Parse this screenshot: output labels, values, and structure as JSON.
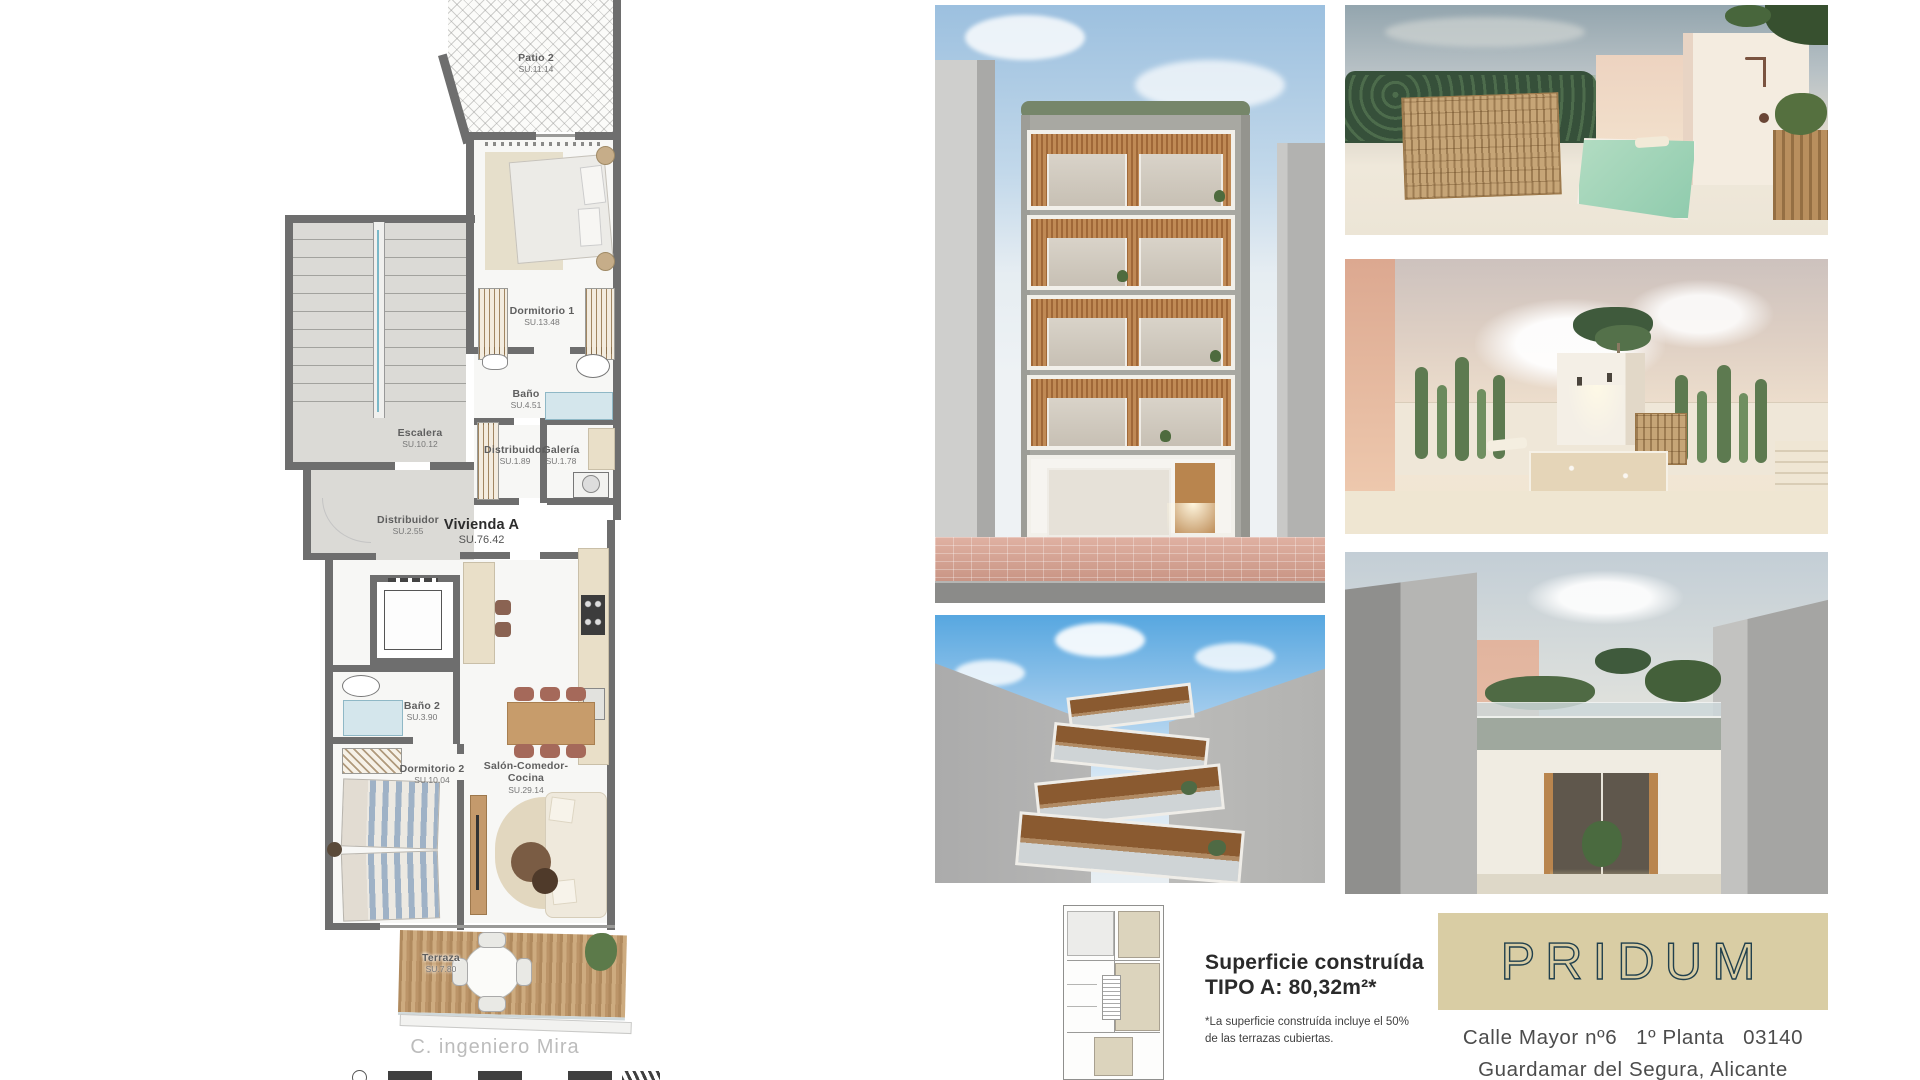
{
  "floor_plan": {
    "street_label": "C. ingeniero Mira",
    "unit_label": {
      "name": "Vivienda A",
      "area": "SU.76.42"
    },
    "rooms": [
      {
        "id": "patio2",
        "name": "Patio 2",
        "area": "SU.11.14"
      },
      {
        "id": "dormitorio1",
        "name": "Dormitorio 1",
        "area": "SU.13.48"
      },
      {
        "id": "bano1",
        "name": "Baño",
        "area": "SU.4.51"
      },
      {
        "id": "escalera",
        "name": "Escalera",
        "area": "SU.10.12"
      },
      {
        "id": "distribuidor1",
        "name": "Distribuidor",
        "area": "SU.1.89"
      },
      {
        "id": "galeria",
        "name": "Galería",
        "area": "SU.1.78"
      },
      {
        "id": "distribuidor2",
        "name": "Distribuidor",
        "area": "SU.2.55"
      },
      {
        "id": "bano2",
        "name": "Baño 2",
        "area": "SU.3.90"
      },
      {
        "id": "dormitorio2",
        "name": "Dormitorio 2",
        "area": "SU.10.04"
      },
      {
        "id": "salon",
        "name": "Salón-Comedor-Cocina",
        "area": "SU.29.14"
      },
      {
        "id": "terraza",
        "name": "Terraza",
        "area": "SU.7.80"
      }
    ]
  },
  "summary": {
    "title_line1": "Superficie construída",
    "title_line2": "TIPO A: 80,32m²*",
    "footnote": "*La superficie construída incluye el 50% de las  terrazas cubiertas."
  },
  "brand": {
    "logo": "PRIDUM",
    "address_line1": "Calle Mayor nº6   1º Planta   03140",
    "address_line2": "Guardamar del Segura, Alicante",
    "logo_bg": "#d9cda4",
    "logo_color": "#21404d",
    "wall_color": "#6e6e6e"
  }
}
